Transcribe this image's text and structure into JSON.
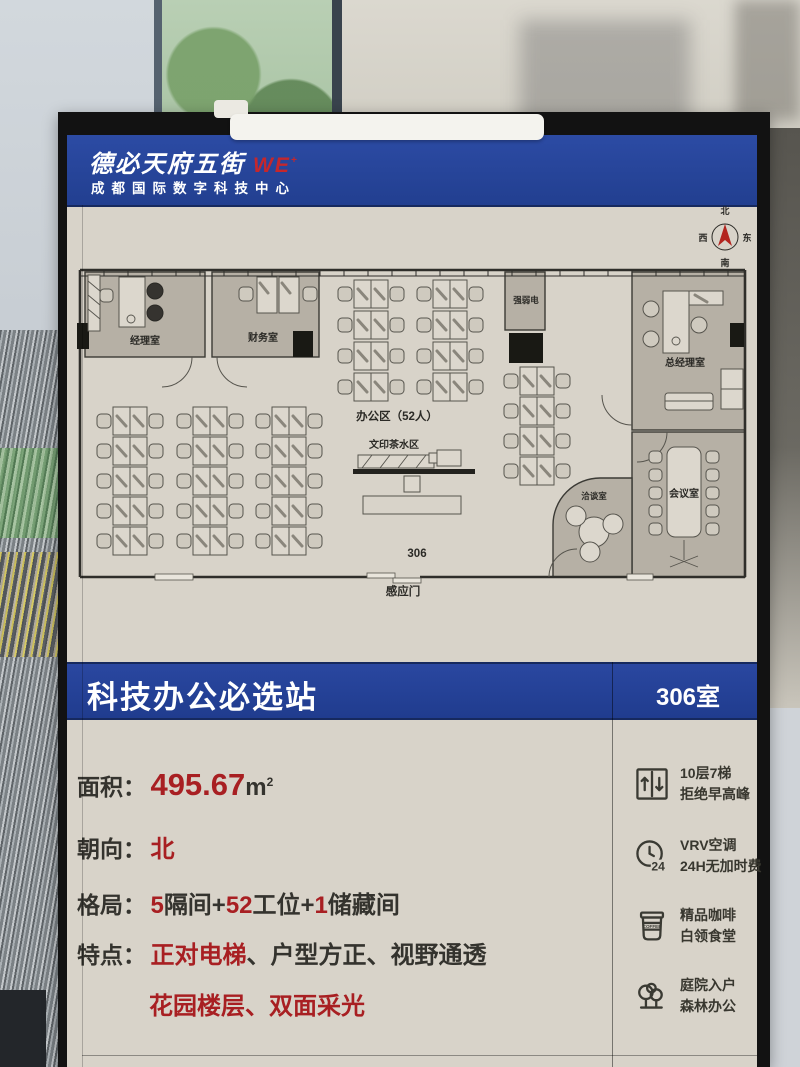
{
  "poster": {
    "header": {
      "brand": "德必天府五街",
      "brand_mark": "WE",
      "brand_mark_sup": "+",
      "subtitle": "成都国际数字科技中心"
    },
    "compass": {
      "n": "北",
      "s": "南",
      "e": "东",
      "w": "西"
    },
    "plan": {
      "rooms": {
        "manager": "经理室",
        "finance": "财务室",
        "utility": "强弱电",
        "gm": "总经理室",
        "meeting": "会议室",
        "negotiate": "洽谈室"
      },
      "labels": {
        "office_area": "办公区（52人）",
        "print_tea": "文印茶水区",
        "suite": "306",
        "entry_door": "感应门"
      }
    },
    "banner": {
      "title": "科技办公必选站",
      "room_no": "306室"
    },
    "details": {
      "area": {
        "label": "面积：",
        "value": "495.67",
        "unit_base": "m",
        "unit_sup": "2"
      },
      "facing": {
        "label": "朝向：",
        "value": "北"
      },
      "layout": {
        "label": "格局：",
        "segments": [
          "5",
          "隔间+",
          "52",
          "工位+",
          "1",
          "储藏间"
        ]
      },
      "features": {
        "label": "特点：",
        "line1": [
          "正对电梯",
          "、",
          "户型方正",
          "、",
          "视野通透"
        ],
        "line2": [
          "花园楼层",
          "、",
          "双面采光"
        ]
      }
    },
    "amenities": [
      {
        "icon": "elevator-icon",
        "line1": "10层7梯",
        "line2": "拒绝早高峰"
      },
      {
        "icon": "clock-24h-icon",
        "icon_text": "24",
        "line1": "VRV空调",
        "line2": "24H无加时费"
      },
      {
        "icon": "coffee-icon",
        "icon_text": "COFFEE",
        "line1": "精品咖啡",
        "line2": "白领食堂"
      },
      {
        "icon": "trees-icon",
        "line1": "庭院入户",
        "line2": "森林办公"
      }
    ],
    "colors": {
      "brand_blue": "#25439A",
      "accent_red": "#A81F22",
      "poster_bg": "#D8D3C9",
      "room_fill": "#B6B0A5"
    }
  }
}
